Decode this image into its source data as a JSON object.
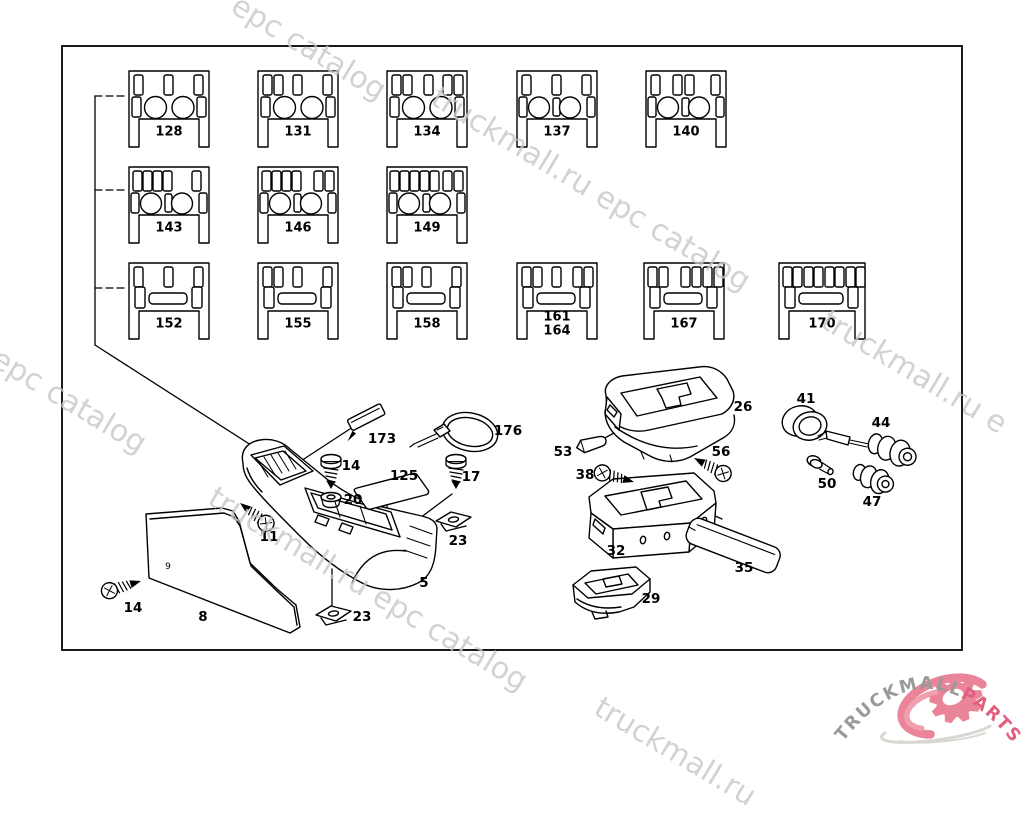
{
  "meta": {
    "title": "Center console switch panel variants - parts diagram",
    "width": 1024,
    "height": 750
  },
  "frame": {
    "x": 62,
    "y": 46,
    "w": 900,
    "h": 604
  },
  "panel_style": {
    "w": 82,
    "h": 78,
    "label_color": "#000000"
  },
  "panels": [
    {
      "labels": [
        "128"
      ],
      "x": 128,
      "y": 70,
      "top": [
        6,
        36,
        66
      ],
      "mid": "circles2"
    },
    {
      "labels": [
        "131"
      ],
      "x": 257,
      "y": 70,
      "top": [
        6,
        17,
        36,
        66
      ],
      "mid": "circles2"
    },
    {
      "labels": [
        "134"
      ],
      "x": 386,
      "y": 70,
      "top": [
        6,
        17,
        38,
        57,
        68
      ],
      "mid": "circles2"
    },
    {
      "labels": [
        "137"
      ],
      "x": 516,
      "y": 70,
      "top": [
        6,
        36,
        66
      ],
      "mid": "circles2split"
    },
    {
      "labels": [
        "140"
      ],
      "x": 645,
      "y": 70,
      "top": [
        6,
        28,
        40,
        66
      ],
      "mid": "circles2split"
    },
    {
      "labels": [
        "143"
      ],
      "x": 128,
      "y": 166,
      "top": [
        5,
        15,
        25,
        35,
        64
      ],
      "mid": "circles2split"
    },
    {
      "labels": [
        "146"
      ],
      "x": 257,
      "y": 166,
      "top": [
        5,
        15,
        25,
        35,
        57,
        68
      ],
      "mid": "circles2split"
    },
    {
      "labels": [
        "149"
      ],
      "x": 386,
      "y": 166,
      "top": [
        4,
        14,
        24,
        34,
        44,
        57,
        68
      ],
      "mid": "circles2split"
    },
    {
      "labels": [
        "152"
      ],
      "x": 128,
      "y": 262,
      "top": [
        6,
        36,
        66
      ],
      "mid": "bar"
    },
    {
      "labels": [
        "155"
      ],
      "x": 257,
      "y": 262,
      "top": [
        6,
        17,
        36,
        66
      ],
      "mid": "bar"
    },
    {
      "labels": [
        "158"
      ],
      "x": 386,
      "y": 262,
      "top": [
        6,
        17,
        36,
        66
      ],
      "mid": "bar"
    },
    {
      "labels": [
        "161",
        "164"
      ],
      "x": 516,
      "y": 262,
      "top": [
        6,
        17,
        36,
        57,
        68
      ],
      "mid": "bar"
    },
    {
      "labels": [
        "167"
      ],
      "x": 643,
      "y": 262,
      "top": [
        5,
        16,
        38,
        49,
        60,
        71
      ],
      "mid": "bar"
    },
    {
      "labels": [
        "170"
      ],
      "x": 778,
      "y": 262,
      "w": 88,
      "top": [
        5,
        15,
        26,
        36,
        47,
        57,
        68,
        78
      ],
      "mid": "bar"
    }
  ],
  "lines": [
    {
      "x1": 95,
      "y1": 96,
      "x2": 128,
      "y2": 96,
      "dash": true
    },
    {
      "x1": 95,
      "y1": 96,
      "x2": 95,
      "y2": 345
    },
    {
      "x1": 95,
      "y1": 190,
      "x2": 128,
      "y2": 190,
      "dash": true
    },
    {
      "x1": 95,
      "y1": 288,
      "x2": 127,
      "y2": 288,
      "dash": true
    },
    {
      "x1": 95,
      "y1": 345,
      "x2": 268,
      "y2": 456,
      "arrow": true
    },
    {
      "x1": 356,
      "y1": 425,
      "x2": 284,
      "y2": 472,
      "arrow": true
    },
    {
      "x1": 452,
      "y1": 494,
      "x2": 416,
      "y2": 521
    },
    {
      "x1": 387,
      "y1": 506,
      "x2": 387,
      "y2": 561
    },
    {
      "x1": 332,
      "y1": 569,
      "x2": 332,
      "y2": 606
    },
    {
      "x1": 404,
      "y1": 523,
      "x2": 433,
      "y2": 525
    },
    {
      "x1": 697,
      "y1": 508,
      "x2": 722,
      "y2": 519
    },
    {
      "x1": 599,
      "y1": 441,
      "x2": 614,
      "y2": 433
    }
  ],
  "parts": [
    {
      "shape": "console",
      "label": "5",
      "lx": 424,
      "ly": 583
    },
    {
      "shape": "sidepanel",
      "label": "8",
      "lx": 203,
      "ly": 617
    },
    {
      "shape": "armrest",
      "label": "26",
      "lx": 743,
      "ly": 407
    },
    {
      "shape": "storagebox",
      "label": "32",
      "lx": 616,
      "ly": 551
    },
    {
      "shape": "lid",
      "label": "35",
      "lx": 744,
      "ly": 568
    },
    {
      "shape": "tray",
      "label": "29",
      "lx": 651,
      "ly": 599
    },
    {
      "shape": "plate",
      "label": "125",
      "lx": 404,
      "ly": 476
    },
    {
      "shape": "clipAngled",
      "label": "173",
      "lx": 382,
      "ly": 439,
      "tx": 352,
      "ty": 430,
      "rot": -27
    },
    {
      "shape": "cabletie",
      "label": "176",
      "lx": 508,
      "ly": 431,
      "tx": 440,
      "ty": 432
    },
    {
      "shape": "screwV",
      "label": "14",
      "lx": 351,
      "ly": 466,
      "tx": 331,
      "ty": 455
    },
    {
      "shape": "screwV",
      "label": "17",
      "lx": 471,
      "ly": 477,
      "tx": 456,
      "ty": 455
    },
    {
      "shape": "grommet",
      "label": "20",
      "lx": 353,
      "ly": 500,
      "tx": 331,
      "ty": 497
    },
    {
      "shape": "screwPoint",
      "label": "11",
      "lx": 269,
      "ly": 537,
      "tx": 240,
      "ty": 503,
      "rot": 38
    },
    {
      "shape": "screwPoint",
      "label": "14",
      "lx": 133,
      "ly": 608,
      "tx": 141,
      "ty": 581,
      "rot": 163
    },
    {
      "shape": "clip",
      "label": "23",
      "lx": 362,
      "ly": 617,
      "tx": 316,
      "ty": 606
    },
    {
      "shape": "clip",
      "label": "23",
      "lx": 458,
      "ly": 541,
      "tx": 436,
      "ty": 512
    },
    {
      "shape": "pin",
      "label": "53",
      "lx": 563,
      "ly": 452,
      "tx": 575,
      "ty": 442,
      "rot": -17
    },
    {
      "shape": "screwPoint",
      "label": "56",
      "lx": 721,
      "ly": 452,
      "tx": 694,
      "ty": 458,
      "rot": 28
    },
    {
      "shape": "screwPoint",
      "label": "38",
      "lx": 585,
      "ly": 475,
      "tx": 634,
      "ty": 482,
      "rot": 196
    },
    {
      "shape": "ring",
      "label": "41",
      "lx": 806,
      "ly": 399
    },
    {
      "shape": "lighter",
      "label": "44",
      "lx": 881,
      "ly": 423
    },
    {
      "shape": "rivet",
      "label": "50",
      "lx": 827,
      "ly": 484
    },
    {
      "shape": "socket",
      "label": "47",
      "lx": 872,
      "ly": 502
    }
  ],
  "extra_labels": [
    {
      "text": "9",
      "x": 168,
      "y": 567
    }
  ],
  "watermarks": {
    "color": "#c8c8c8",
    "opacity": 0.8,
    "angle": 31,
    "size": 30,
    "items": [
      {
        "text": "epc catalog",
        "x": 243,
        "y": -12
      },
      {
        "text": "truckmall.ru epc catalog",
        "x": 443,
        "y": 80
      },
      {
        "text": "l epc catalog",
        "x": -12,
        "y": 332
      },
      {
        "text": "truckmall.ru e",
        "x": 833,
        "y": 303
      },
      {
        "text": "truckmall.ru epc catalog",
        "x": 220,
        "y": 480
      },
      {
        "text": "truckmall.ru",
        "x": 606,
        "y": 690
      }
    ]
  },
  "logo": {
    "arc_text_left": "TRUCKMALL",
    "arc_text_right": "PARTS",
    "gray": "#9a9a9a",
    "pink": "#e25f7e",
    "gear_pink": "#ea8599",
    "swoosh_pink": "#ef9fae",
    "swoosh_gray": "#d8d8d3"
  }
}
